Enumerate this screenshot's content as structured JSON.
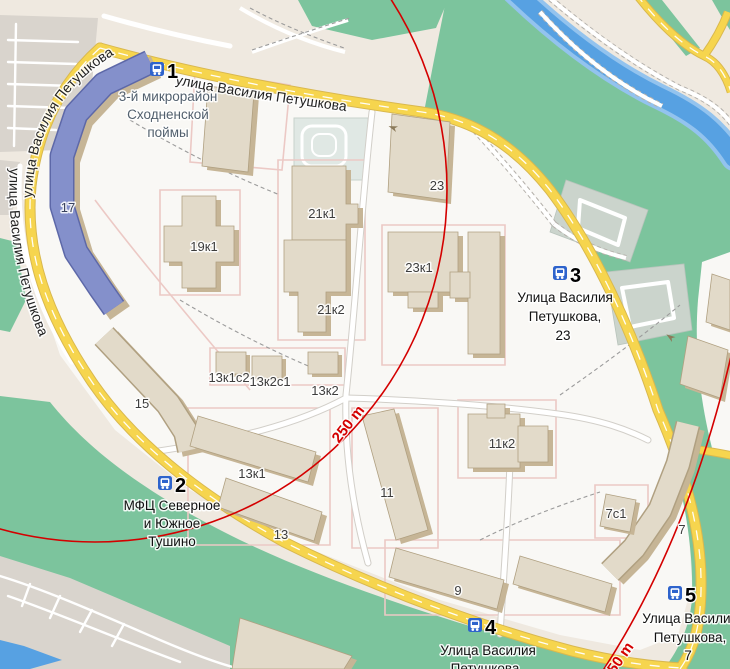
{
  "colors": {
    "land_beige": "#efe9e0",
    "residential": "#f9f8f5",
    "park_green": "#7cc49d",
    "water_blue": "#57a1e2",
    "water_edge": "#93c3ee",
    "road_yellow": "#f6d54e",
    "road_casing": "#d9b84e",
    "building_top": "#e2dac9",
    "building_side": "#c6b596",
    "building_edge": "#b0a081",
    "highlight_roof": "#8490cb",
    "highlight_edge": "#5d68a8",
    "paved_gray": "#d9d4cd",
    "paved_green_gray": "#cbd4cc",
    "sports_gray": "#e0e8e4",
    "pink_path": "#ecc9c5",
    "circle_red": "#d40000",
    "bus_icon_blue": "#2e63cc",
    "district_label": "#52606e"
  },
  "streets": {
    "name": "улица Василия Петушкова"
  },
  "district": {
    "lines": [
      "3-й микрорайон",
      "Сходненской",
      "поймы"
    ]
  },
  "stops": [
    {
      "number": "1"
    },
    {
      "number": "2",
      "name_lines": [
        "МФЦ Северное",
        "и Южное",
        "Тушино"
      ]
    },
    {
      "number": "3",
      "name_lines": [
        "Улица Василия",
        "Петушкова,",
        "23"
      ]
    },
    {
      "number": "4",
      "name_lines": [
        "Улица Василия",
        "Петушкова"
      ]
    },
    {
      "number": "5",
      "name_lines": [
        "Улица Василия",
        "Петушкова,",
        "7"
      ]
    }
  ],
  "buildings": {
    "b17": "17",
    "b19k1": "19к1",
    "b21k1": "21к1",
    "b21k2": "21к2",
    "b23": "23",
    "b23k1": "23к1",
    "b15": "15",
    "b13k1s2": "13к1с2",
    "b13k2s1": "13к2с1",
    "b13k2": "13к2",
    "b13k1": "13к1",
    "b13": "13",
    "b11": "11",
    "b11k2": "11к2",
    "b9": "9",
    "b7s1": "7с1",
    "b7": "7"
  },
  "scale": {
    "label": "250 m"
  }
}
